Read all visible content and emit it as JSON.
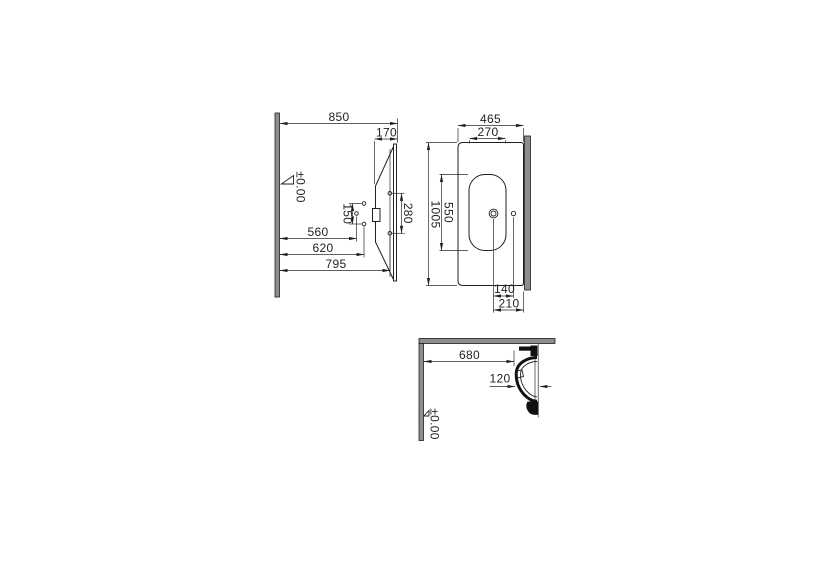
{
  "colors": {
    "line": "#1f1f1f",
    "wall_fill": "#8e8e8e",
    "background": "#ffffff"
  },
  "side_view": {
    "dim_850": "850",
    "dim_170": "170",
    "dim_280": "280",
    "dim_150": "150",
    "dim_560": "560",
    "dim_620": "620",
    "dim_795": "795",
    "datum": "±0.00"
  },
  "plan_view": {
    "dim_465": "465",
    "dim_270": "270",
    "dim_1005": "1005",
    "dim_550": "550",
    "dim_140": "140",
    "dim_210": "210"
  },
  "section_view": {
    "dim_680": "680",
    "dim_120": "120",
    "datum": "±0.00"
  }
}
